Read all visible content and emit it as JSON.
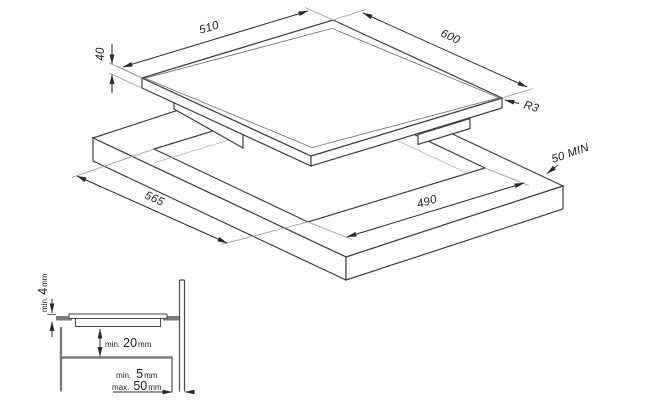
{
  "isometric": {
    "hob_width": "510",
    "hob_depth": "600",
    "hob_thickness": "40",
    "corner_radius": "R3",
    "rear_clearance": "50 MIN",
    "cutout_width": "565",
    "cutout_depth": "490"
  },
  "section": {
    "glass_protrusion": {
      "prefix": "min.",
      "value": "4",
      "unit": "mm"
    },
    "clearance_below": {
      "prefix": "min.",
      "value": "20",
      "unit": "mm"
    },
    "wall_gap_min": {
      "prefix": "min.",
      "value": "5",
      "unit": "mm"
    },
    "wall_gap_max": {
      "prefix": "max.",
      "value": "50",
      "unit": "mm"
    }
  },
  "colors": {
    "line": "#3f3f3f",
    "dimension": "#2b2b2b",
    "extension": "#9b9b9b",
    "section_gray": "#7d7d7d",
    "background": "#ffffff"
  }
}
